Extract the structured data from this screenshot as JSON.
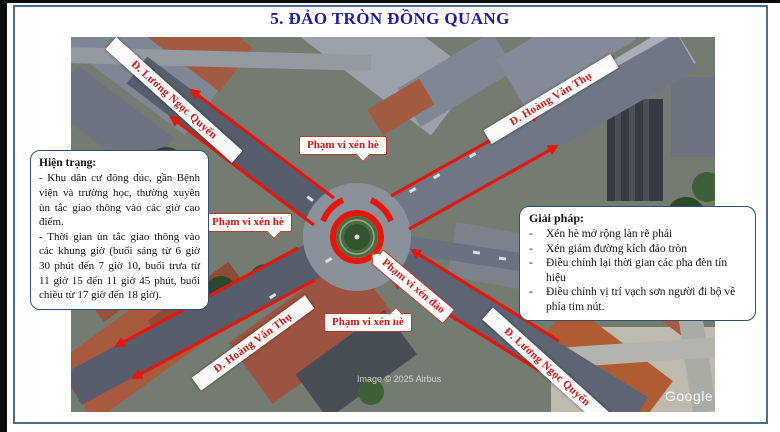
{
  "title": "5. ĐẢO TRÒN ĐỒNG QUANG",
  "hien_trang": {
    "heading": "Hiện trạng:",
    "paragraphs": [
      "- Khu dân cư đông đúc, gần Bệnh viện và trường học, thường xuyên ùn tắc giao thông vào các giờ cao điểm.",
      "- Thời gian ùn tắc giao thông vào các khung giờ (buổi sáng từ 6 giờ 30 phút đến 7 giờ 10, buổi trưa từ 11 giờ 15 đến 11 giờ 45 phút, buổi chiều từ 17 giờ đến 18 giờ)."
    ]
  },
  "giai_phap": {
    "heading": "Giải pháp:",
    "bullet_char": "-",
    "items": [
      "Xén hè mở rộng làn rẽ phải",
      "Xén giảm đường kích đảo tròn",
      "Điều chỉnh lại thời gian các pha đèn tín hiệu",
      "Điều chỉnh vị trí vạch sơn người đi bộ về phía tim nút."
    ]
  },
  "map": {
    "street_labels": [
      {
        "text": "Đ. Lương Ngọc Quyến"
      },
      {
        "text": "Đ. Hoàng Văn Thụ"
      },
      {
        "text": "Đ. Hoàng Văn Thụ"
      },
      {
        "text": "Đ. Lương Ngọc Quyến"
      }
    ],
    "callouts": [
      {
        "text": "Phạm vi xén hè"
      },
      {
        "text": "Phạm vi xén hè"
      },
      {
        "text": "Phạm vi xén hè"
      },
      {
        "text": "Phạm vi xén đảo"
      }
    ],
    "watermarks": {
      "imagery": "Image © 2025 Airbus",
      "brand": "Google"
    }
  },
  "colors": {
    "title_navy": "#1b1ba8",
    "annotation_red": "#d21616",
    "arrow_red": "#e3170c",
    "box_border_blue": "#2f4f74",
    "slide_border_blue": "#4a6d96"
  }
}
